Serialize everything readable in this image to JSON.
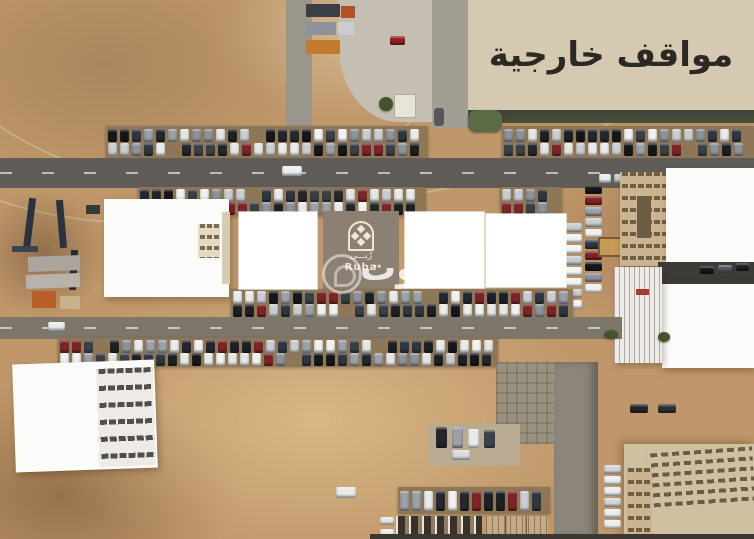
{
  "banner": {
    "label": "مواقف خارجية",
    "bg": "#d6c9b2",
    "text_color": "#2a2922"
  },
  "logo": {
    "arabic": "رُبـــى",
    "latin": "Ruba",
    "dots": "· ·",
    "block_bg": "#8c8072",
    "ink": "#f1e7d3"
  },
  "photo_watermark": {
    "letters": "وت"
  },
  "scene": {
    "ground_color": "#bf976a",
    "asphalt_color": "#605d58",
    "parking_surface_color": "#8d7757",
    "white_building_color": "#fbfbfa",
    "beige_building_color": "#cbb491",
    "car_colors": [
      "#15171b",
      "#e9eaea",
      "#2e3642",
      "#c9cdd1",
      "#1d2025",
      "#8d939b",
      "#7e2426",
      "#e5e6e4",
      "#394047",
      "#f0f1f0",
      "#23272e",
      "#9aa1a8"
    ],
    "car_colors_light": [
      "#eceeed",
      "#dfe2e2",
      "#c8cccd",
      "#f2f3f2",
      "#d2d5d6"
    ]
  }
}
